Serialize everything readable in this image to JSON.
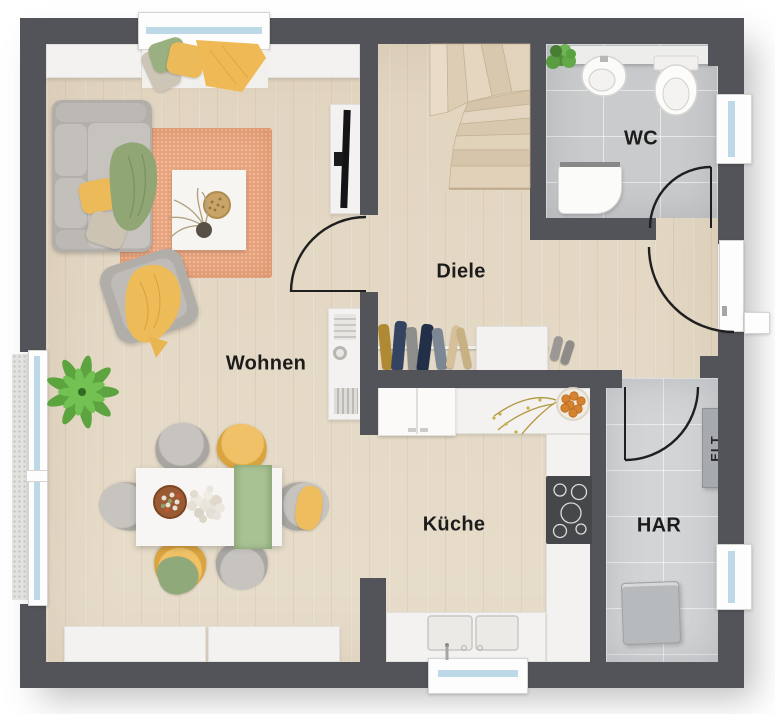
{
  "labels": {
    "wohnen": "Wohnen",
    "diele": "Diele",
    "wc": "WC",
    "kueche": "Küche",
    "har": "HAR",
    "elt": "ELT"
  },
  "colors": {
    "wall": "#53545a",
    "wood_floor": "#e7ddcb",
    "tile_floor": "#c9cbcd",
    "tile_floor_light": "#d2d4d6",
    "counter_white": "#f3f2f0",
    "accent_yellow": "#eebb5c",
    "accent_green": "#90a675",
    "rug_terracotta": "#e9a47d",
    "window_glass": "#bdd8e7",
    "label_text": "#1c1c1c"
  },
  "furniture_icons": [
    "sofa",
    "armchair",
    "coffee-table",
    "rug",
    "tv",
    "window-bench",
    "dining-table",
    "dining-chairs",
    "sideboard",
    "palm-plant",
    "coat-rack",
    "shoe-cabinet",
    "slippers",
    "stairs",
    "wc-sink",
    "toilet",
    "wc-cabinet",
    "wc-plant",
    "kitchen-counter",
    "fridge",
    "cooktop",
    "kitchen-sink",
    "fruit-bowl",
    "flower-branch",
    "elt-cabinet",
    "washer",
    "entrance-door",
    "interior-doors",
    "windows"
  ]
}
